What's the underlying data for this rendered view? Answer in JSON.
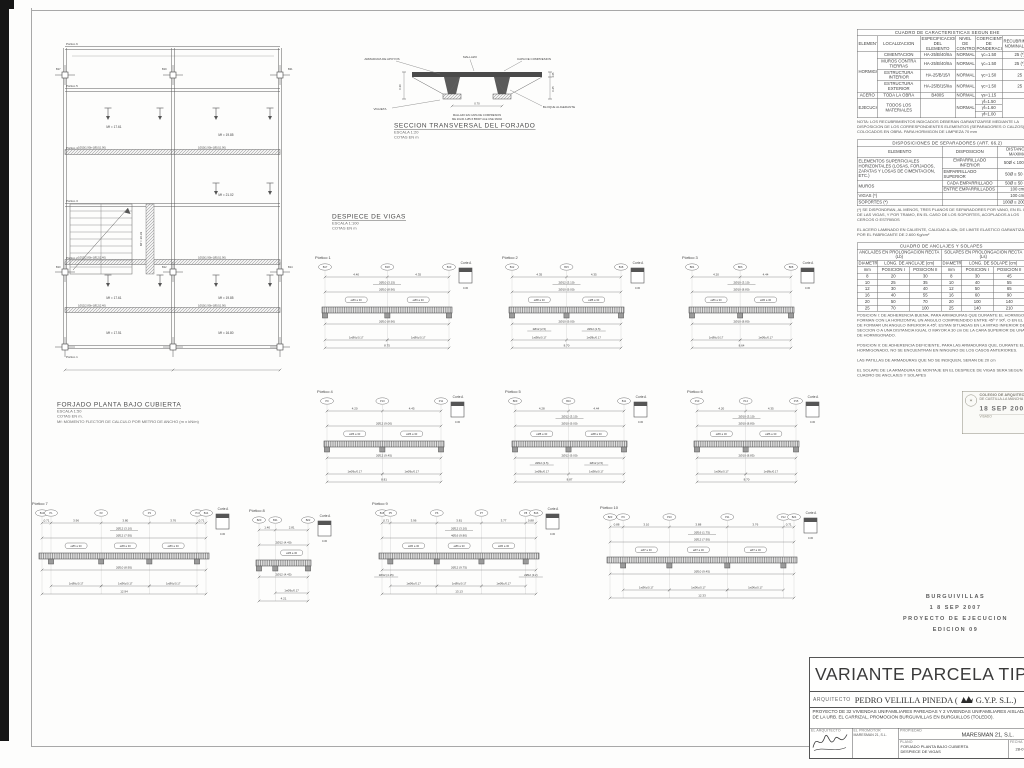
{
  "plan": {
    "title": "FORJADO PLANTA BAJO CUBIERTA",
    "scale": "ESCALA 1:50",
    "units": "COTAS EN m.",
    "note": "Mf: MOMENTO FLECTOR DE CALCULO POR METRO DE ANCHO (m x kN/m)",
    "portico_labels": [
      "Pórtico 6",
      "Pórtico 5",
      "Pórtico 4",
      "Pórtico 3",
      "Pórtico 2",
      "Pórtico 1"
    ],
    "mf_values": [
      "Mf = 17.61",
      "Mf = 19.85",
      "Mf = 21.02",
      "Mf = 20.39",
      "Mf = 17.61",
      "Mf = 19.85",
      "Mf = 17.51",
      "Mf = 16.80"
    ],
    "rebar_callouts": [
      "1Ø10(1.90)+1Ø10(1.90)",
      "1Ø10(1.90)+1Ø10(1.90)",
      "1Ø12(2.80)+1Ø12(2.40)",
      "1Ø10(1.90)+1Ø10(1.90)",
      "1Ø12(2.80)+1Ø12(2.40)",
      "1Ø10(1.90)+1Ø10(1.90)"
    ],
    "node_tags": [
      "B17",
      "B19",
      "B21",
      "B10",
      "B12",
      "B14"
    ]
  },
  "section": {
    "title": "SECCION TRANSVERSAL DEL FORJADO",
    "scale": "ESCALA 1:20",
    "units": "COTAS EN m",
    "labels": {
      "armadura": "ARMADURA DE APOYOS",
      "mallazo": "MALLAZO",
      "capa": "CAPA DE COMPRESION",
      "vigueta": "VIGUETA",
      "bloque": "BLOQUE ALIGERANTE"
    },
    "note1": "MALLAZO EN CAPA DE COMPRESION",
    "note2": "ME 20x30 A Ø5-5 B500T ALE UNE 36092",
    "dims": {
      "ancho": "0.70",
      "canto": "0.25",
      "capa": "0.05",
      "total": "0.30"
    }
  },
  "despiece": {
    "title": "DESPIECE DE VIGAS",
    "scale": "ESCALA 1:100",
    "units": "COTAS EN m"
  },
  "porticos": [
    {
      "label": "Pórtico 1",
      "tags": [
        "B17",
        "B18",
        "B19"
      ],
      "spans": [
        "4.40",
        "4.35"
      ],
      "top_note": "2Ø10 (3.15)",
      "top_main": "2Ø10 (8.90)",
      "box": "eØ6 a 30",
      "bottom_main": "2Ø10 (8.90)",
      "stirrup": "1eØ6c/0.17",
      "total": "8.75",
      "corte": "Corte A",
      "corte_dim": "0.30"
    },
    {
      "label": "Pórtico 2",
      "tags": [
        "B12",
        "B15",
        "B18"
      ],
      "spans": [
        "4.35",
        "4.35"
      ],
      "top_note": "2Ø12 (3.10)",
      "top_main": "2Ø10 (9.00)",
      "box": "eØ8 a 30",
      "bottom_main": "2Ø10 (9.00)",
      "bottom_notes": [
        "2Ø12 (2.5)",
        "2Ø12 (2.5)"
      ],
      "stirrup": "1eØ8c/0.17",
      "total": "8.70",
      "corte": "Corte A",
      "corte_dim": "0.30"
    },
    {
      "label": "Pórtico 3",
      "tags": [
        "B04",
        "B06",
        "B08"
      ],
      "spans": [
        "4.20",
        "4.44"
      ],
      "top_note": "2Ø10 (3.10)",
      "top_main": "2Ø10 (8.80)",
      "box": "eØ6 a 30",
      "bottom_main": "2Ø10 (8.80)",
      "stirrup": "1eØ6c/0.17",
      "total": "8.64",
      "corte": "Corte A",
      "corte_dim": "0.30"
    },
    {
      "label": "Pórtico 4",
      "tags": [
        "P9",
        "P10",
        "P11"
      ],
      "spans": [
        "4.20",
        "4.45"
      ],
      "top_main": "2Ø12 (9.00)",
      "box": "eØ6 a 30",
      "bottom_main": "2Ø12 (9.45)",
      "stirrup": "1eØ6c/0.17",
      "total": "8.81",
      "corte": "Corte A",
      "corte_dim": "0.30"
    },
    {
      "label": "Pórtico 5",
      "tags": [
        "B09",
        "B10",
        "B11"
      ],
      "spans": [
        "4.28",
        "4.44"
      ],
      "top_note": "2Ø12 (3.10)",
      "top_main": "2Ø10 (9.00)",
      "box": "eØ8 a 30",
      "bottom_main": "2Ø12 (9.00)",
      "bottom_notes": [
        "2Ø12 (2.5)",
        "2Ø12 (2.5)"
      ],
      "stirrup": "1eØ8c/0.17",
      "total": "8.87",
      "corte": "Corte A",
      "corte_dim": "0.30"
    },
    {
      "label": "Pórtico 6",
      "tags": [
        "P13",
        "P14",
        "P15"
      ],
      "spans": [
        "4.20",
        "4.35"
      ],
      "top_note": "2Ø10 (3.10)",
      "top_main": "2Ø10 (8.80)",
      "box": "eØ6 a 30",
      "bottom_main": "2Ø10 (8.85)",
      "stirrup": "1eØ6c/0.17",
      "total": "8.70",
      "corte": "Corte A",
      "corte_dim": "0.30"
    },
    {
      "label": "Pórtico 7",
      "tags": [
        "B13",
        "P1",
        "P2",
        "P3",
        "P4",
        "B14"
      ],
      "spans": [
        "0.71",
        "3.96",
        "3.80",
        "3.76",
        "0.71"
      ],
      "top_note": "2Ø12 (3.10)",
      "top_main": "2Ø12 (7.95)",
      "box": "eØ6 a 30",
      "bottom_main": "2Ø10 (8.95)",
      "stirrup": "1eØ6c/0.17",
      "total": "12.94",
      "corte": "Corte A",
      "corte_dim": "0.30"
    },
    {
      "label": "Pórtico 8",
      "tags": [
        "B20",
        "B21",
        "B22"
      ],
      "spans": [
        "1.40",
        "2.81"
      ],
      "top_main": "2Ø12 (4.40)",
      "box": "eØ6 a 30",
      "bottom_main": "2Ø12 (4.45)",
      "stirrup": "1eØ6c/0.17",
      "total": "4.21",
      "corte": "Corte A",
      "corte_dim": "0.30"
    },
    {
      "label": "Pórtico 9",
      "tags": [
        "B15",
        "P5",
        "P6",
        "P7",
        "P8",
        "B16"
      ],
      "spans": [
        "0.71",
        "3.96",
        "3.81",
        "3.77",
        "0.88"
      ],
      "top_note": "2Ø12 (3.10)",
      "top_main": "4Ø16 (9.80)",
      "box": "eØ6 a 30",
      "bottom_main": "2Ø12 (9.75)",
      "bottom_notes": [
        "2Ø12 (4.15)",
        "2Ø12 (3.2)"
      ],
      "stirrup": "1eØ6c/0.17",
      "total": "13.13",
      "corte": "Corte A",
      "corte_dim": "0.30"
    },
    {
      "label": "Pórtico 10",
      "tags": [
        "B23",
        "P9",
        "P10",
        "P11",
        "P12",
        "B24"
      ],
      "spans": [
        "0.88",
        "3.10",
        "3.88",
        "3.76",
        "0.71"
      ],
      "top_note": "2Ø16 (1.75)",
      "top_main": "2Ø12 (7.95)",
      "box": "eØ7 a 30",
      "bottom_main": "2Ø10 (9.45)",
      "stirrup": "1eØ6c/0.17",
      "total": "12.33",
      "corte": "Corte A",
      "corte_dim": "0.30"
    }
  ],
  "tables": {
    "caracteristicas": {
      "title": "CUADRO DE CARACTERISTICAS SEGUN EHE",
      "headers": [
        "ELEMENTO",
        "LOCALIZACION",
        "ESPECIFICACION DEL ELEMENTO",
        "NIVEL DE CONTROL",
        "COEFICIENTE DE PONDERACION",
        "RECUBRIMIENTO NOMINAL (mm)"
      ],
      "rows": [
        [
          {
            "t": "HORMIGON",
            "rs": 4
          },
          "CIMENTACION",
          "HA-25/B/40/IIa",
          "NORMAL",
          "γc=1.50",
          "25 (*)"
        ],
        [
          "MUROS CONTRA TIERRAS",
          "HA-25/B/40/IIa",
          "NORMAL",
          "γc=1.50",
          "25 (*)"
        ],
        [
          "ESTRUCTURA INTERIOR",
          "HA-25/B/15/I",
          "NORMAL",
          "γc=1.50",
          "25"
        ],
        [
          "ESTRUCTURA EXTERIOR",
          "HA-25/B/15/IIa",
          "NORMAL",
          "γc=1.50",
          "25"
        ],
        [
          "ACERO",
          "TODA LA OBRA",
          "B400S",
          "NORMAL",
          "γs=1.15",
          ""
        ],
        [
          {
            "t": "EJECUCION",
            "rs": 3
          },
          {
            "t": "TODOS LOS MATERIALES",
            "rs": 3
          },
          {
            "t": "",
            "rs": 3
          },
          {
            "t": "NORMAL",
            "rs": 3
          },
          "γf=1.50",
          {
            "t": "",
            "rs": 3
          }
        ],
        [
          "γf=1.60"
        ],
        [
          "γf=1.00"
        ]
      ],
      "note": "NOTA: LOS RECUBRIMIENTOS INDICADOS DEBERAN GARANTIZARSE MEDIANTE LA DISPOSICION DE LOS CORRESPONDIENTES ELEMENTOS (SEPARADORES O CALZOS) COLOCADOS EN OBRA. PARA HORMIGON DE LIMPIEZA 70 mm"
    },
    "separadores": {
      "title": "DISPOSICIONES DE SEPARADORES (ART. 66.2)",
      "headers": [
        "ELEMENTO",
        "DISPOSICION",
        "DISTANCIA MAXIMA"
      ],
      "rows": [
        [
          {
            "t": "ELEMENTOS SUPERFICIALES HORIZONTALES (LOSAS, FORJADOS, ZAPATAS Y LOSAS DE CIMENTACION, ETC.)",
            "rs": 2
          },
          "EMPARRILLADO INFERIOR",
          "50Ø ≤ 100 cm"
        ],
        [
          "EMPARRILLADO SUPERIOR",
          "50Ø ≤ 50 cm"
        ],
        [
          {
            "t": "MUROS",
            "rs": 2
          },
          "CADA EMPARRILLADO",
          "50Ø ≤ 50 cm"
        ],
        [
          "ENTRE EMPARRILLADOS",
          "100 cm"
        ],
        [
          "VIGAS (*)",
          "",
          "100 cm"
        ],
        [
          "SOPORTES (*)",
          "",
          "100Ø ≤ 200 cm"
        ]
      ],
      "note1": "(*) SE DISPONDRAN, AL MENOS, TRES PLANOS DE SEPARADORES POR VANO, EN EL CASO DE LAS VIGAS, Y POR TRAMO, EN EL CASO DE LOS SOPORTES, ACOPLADOS A LOS CERCOS O ESTRIBOS",
      "note2": "EL ACERO LAMINADO EN CALIENTE, CALIDAD A-42b, DE LIMITE ELASTICO GARANTIZADO POR EL FABRICANTE DE 2.600 Kg/cm²"
    },
    "anclajes": {
      "title": "CUADRO DE ANCLAJES Y SOLAPES",
      "group1": "ANCLAJES EN PROLONGACION RECTA (Lb)",
      "group2": "SOLAPES EN PROLONGACION RECTA (Ls)",
      "sub_diam": "DIAMETRO",
      "sub_anclaje": "LONG. DE ANCLAJE (cm)",
      "sub_solape": "LONG. DE SOLAPE (cm)",
      "cols": [
        "mm",
        "POSICION I",
        "POSICION II",
        "mm",
        "POSICION I",
        "POSICION II"
      ],
      "rows": [
        [
          "8",
          "20",
          "30",
          "8",
          "30",
          "45"
        ],
        [
          "10",
          "25",
          "35",
          "10",
          "40",
          "55"
        ],
        [
          "12",
          "30",
          "40",
          "12",
          "50",
          "65"
        ],
        [
          "16",
          "40",
          "55",
          "16",
          "60",
          "90"
        ],
        [
          "20",
          "50",
          "70",
          "20",
          "100",
          "140"
        ],
        [
          "25",
          "70",
          "100",
          "25",
          "140",
          "210"
        ]
      ],
      "note1": "POSICION I: DE ADHERENCIA BUENA, PARA ARMADURAS QUE DURANTE EL HORMIGONADO FORMAN CON LA HORIZONTAL UN ANGULO COMPRENDIDO ENTRE 45º Y 90º, O EN EL CASO DE FORMAR UN ANGULO INFERIOR A 45º, ESTAN SITUADAS EN LA MITAD INFERIOR DE LA SECCION O A UNA DISTANCIA IGUAL O MAYOR A 30 cm DE LA CARA SUPERIOR DE UNA CAPA DE HORMIGONADO.",
      "note2": "POSICION II: DE ADHERENCIA DEFICIENTE, PARA LAS ARMADURAS QUE, DURANTE EL HORMIGONADO, NO SE ENCUENTRAN EN NINGUNO DE LOS CASOS ANTERIORES.",
      "note3": "LAS PATILLAS DE ARMADURAS QUE NO SE INDIQUEN, SERAN DE 20 cm",
      "note4": "EL SOLAPE DE LA ARMADURA DE MONTAJE EN EL DESPIECE DE VIGAS SERA SEGUN CUADRO DE ANCLAJES Y SOLAPES"
    }
  },
  "stamp": {
    "line1": "COLEGIO DE ARQUITECTOS",
    "line2": "DE CASTILLA-LA MANCHA · TOLEDO",
    "date": "18 SEP 2007",
    "visado": "VISADO"
  },
  "edition": {
    "lines": [
      "BURGUIVILLAS",
      "1 8 SEP 2007",
      "PROYECTO DE EJECUCION",
      "EDICION 09"
    ]
  },
  "titleblock": {
    "big_title": "VARIANTE PARCELA TIPO 58/1",
    "arquitecto_label": "ARQUITECTO",
    "arquitecto": "PEDRO VELILLA PINEDA (",
    "firm": "G.Y.P. S.L.)",
    "proyecto": "PROYECTO DE 32 VIVIENDAS UNIFAMILIARES PAREADAS Y 2 VIVIENDAS UNIFAMILIARES AISLADAS, SITAS EN LAS MANZANAS 58 Y 65 DE LA URB. EL CARRIZAL, PROMOCION BURGUIVILLAS EN BURGUILLOS (TOLEDO).",
    "cells": {
      "arquitecto_header": "EL ARQUITECTO",
      "promotor_header": "EL PROMOTOR",
      "promotor_sub": "MARESMAN 21, S.L.",
      "propiedad_label": "PROPIEDAD",
      "propiedad": "MARESMAN 21, S.L.",
      "plano_label": "PLANO",
      "plano1": "FORJADO PLANTA BAJO CUBIERTA",
      "plano2": "DESPIECE DE VIGAS",
      "fecha_label": "FECHA",
      "fecha": "28-07-07",
      "detalle_label": "DETALLE",
      "detalle": "ESTRUCTURA",
      "escala_label": "ESCALA",
      "escala": "1/5",
      "num_label": "Nº",
      "num": "E-1"
    }
  }
}
